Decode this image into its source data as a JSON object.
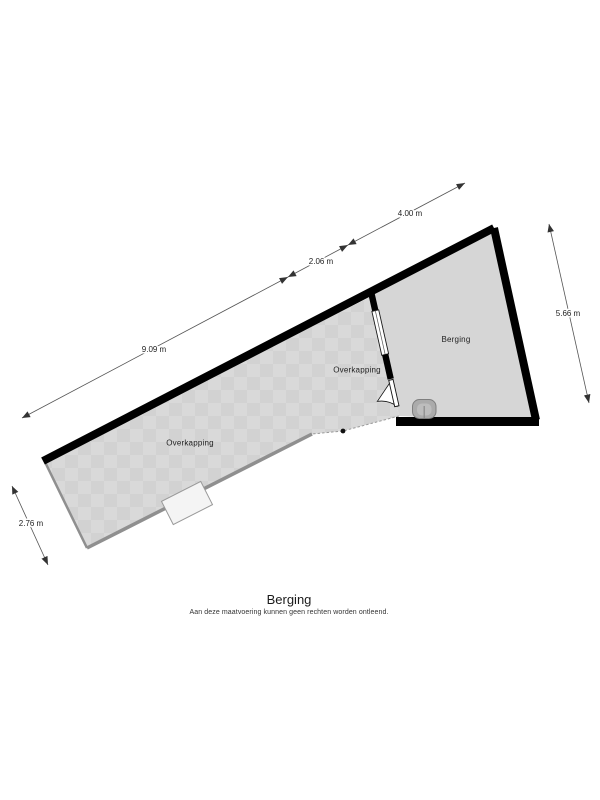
{
  "plan": {
    "rooms": {
      "berging_label": "Berging",
      "overkapping_right_label": "Overkapping",
      "overkapping_left_label": "Overkapping"
    },
    "dimensions": {
      "top_long": "9.09 m",
      "top_mid": "2.06 m",
      "top_short": "4.00 m",
      "right_side": "5.66 m",
      "bottom_left": "2.76 m"
    },
    "colors": {
      "wall": "#000000",
      "floor_base": "#d9d9d9",
      "floor_checker": "#d2d2d2",
      "berging_floor": "#d6d6d6",
      "open_edge": "#8f8f8f",
      "dimension_line": "#555555"
    }
  },
  "footer": {
    "title": "Berging",
    "disclaimer": "Aan deze maatvoering kunnen geen rechten worden ontleend."
  }
}
